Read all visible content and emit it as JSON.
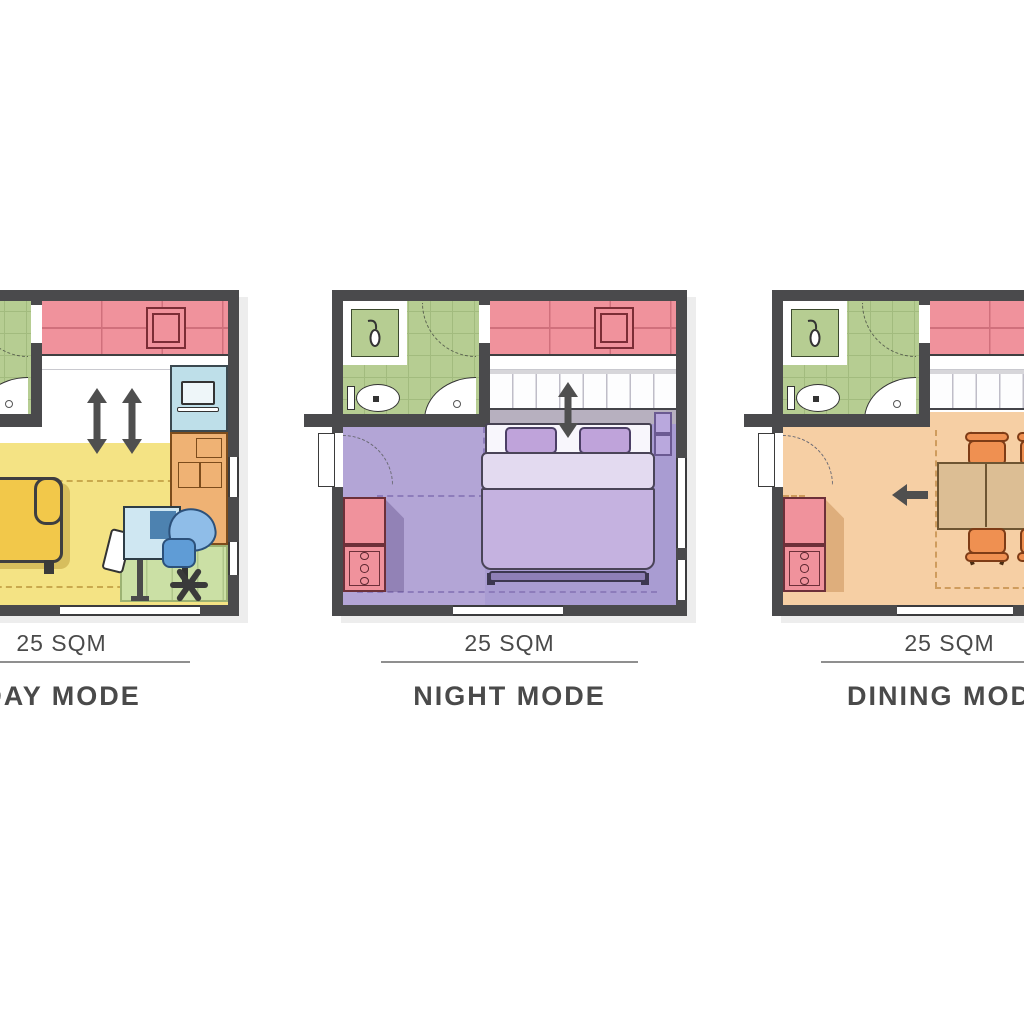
{
  "panels": [
    {
      "id": "day",
      "area_label": "25 SQM",
      "mode_label": "DAY MODE",
      "floor_color": "#f4e384",
      "rooms": [
        "bathroom",
        "kitchenette",
        "living-work-area"
      ],
      "furniture": [
        "sofa",
        "wall-desk-with-laptop",
        "storage-cabinet",
        "writing-desk",
        "monitor",
        "guest-chair",
        "office-chair",
        "green-rug",
        "dashed-rug-outline"
      ],
      "icons": [
        "double-vertical-arrow-icon",
        "double-vertical-arrow-icon"
      ]
    },
    {
      "id": "night",
      "area_label": "25 SQM",
      "mode_label": "NIGHT MODE",
      "floor_color": "#b3a5d6",
      "rooms": [
        "bathroom",
        "kitchenette",
        "sleeping-area"
      ],
      "furniture": [
        "murphy-double-bed",
        "pillow-left",
        "pillow-right",
        "wardrobe-cabinet-strip",
        "bedside-shelves",
        "cooktop-with-burners"
      ],
      "icons": [
        "double-vertical-arrow-icon"
      ]
    },
    {
      "id": "dining",
      "area_label": "25 SQM",
      "mode_label": "DINING MODE",
      "floor_color": "#f6cfa4",
      "rooms": [
        "bathroom",
        "kitchenette",
        "dining-area"
      ],
      "furniture": [
        "extendable-dining-table",
        "dining-chair",
        "dining-chair",
        "dining-chair",
        "dining-chair",
        "wardrobe-cabinet-strip",
        "cooktop-with-burners"
      ],
      "icons": [
        "left-arrow-icon"
      ]
    }
  ],
  "colors": {
    "wall": "#4a4a4c",
    "kitchen": "#f0929c",
    "kitchen-line": "#d0707c",
    "kitchen-sink-border": "#7b2d36",
    "bath": "#b6cd92",
    "bath-grid": "#a2bb7e",
    "arrow": "#4f4f4f",
    "text": "#4a4a4a",
    "divider": "#8f8f8f",
    "day-floor": "#f4e384",
    "day-rug": "#c9a94d",
    "sofa": "#f2c84a",
    "desk-blue": "#bedfe9",
    "desk-table": "#cfe7f2",
    "monitor": "#4d82b0",
    "chair-blue": "#8fbde8",
    "chair-blue-dark": "#5f9cd6",
    "cabinet-orange": "#efb274",
    "rug-green": "#cbe0a5",
    "night-floor": "#b3a5d6",
    "night-floor-dark": "#a99cd2",
    "night-rug": "#8d7cbb",
    "pillow": "#bfa3da",
    "blanket": "#c5b2e0",
    "blanket-light": "#e3daf0",
    "bed-footer": "#8e7fb6",
    "murphy-shadow": "#b7b0bf",
    "dining-floor": "#f6cfa4",
    "dining-rug": "#cf9c5d",
    "table": "#dcbe94",
    "chair-orange": "#ef9051",
    "stove-border": "#6d3039"
  }
}
